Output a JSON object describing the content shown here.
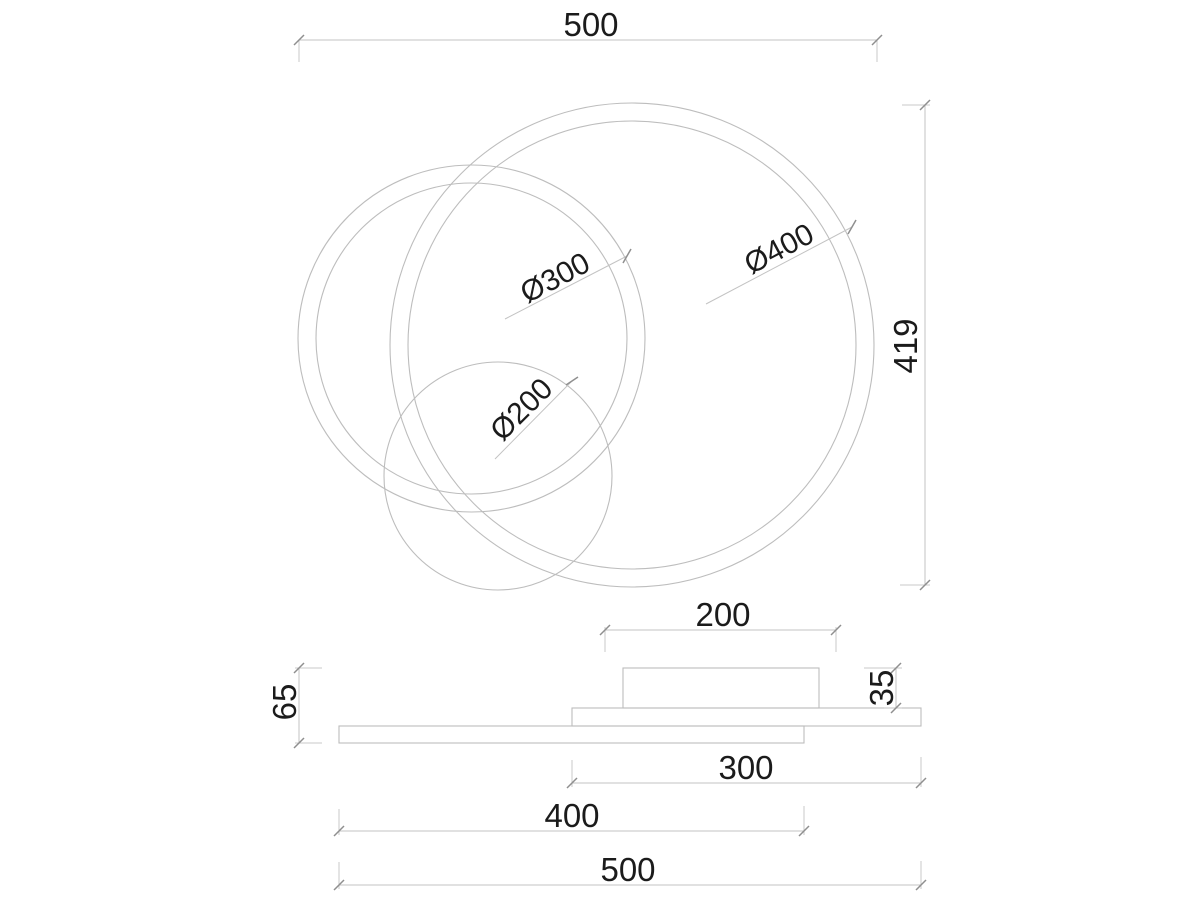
{
  "drawing": {
    "kind": "technical dimension drawing",
    "subject": "ceiling lamp with three overlapping rings (top view) and side elevation",
    "colors": {
      "background": "#ffffff",
      "line": "#bdbdbd",
      "text": "#1b1b1b"
    },
    "top_view": {
      "overall_width": {
        "label": "500",
        "value_mm": 500
      },
      "overall_height": {
        "label": "419",
        "value_mm": 419
      },
      "ring_large": {
        "label": "Ø400",
        "value_mm": 400
      },
      "ring_medium": {
        "label": "Ø300",
        "value_mm": 300
      },
      "disc_small": {
        "label": "Ø200",
        "value_mm": 200
      }
    },
    "side_view": {
      "canopy_width": {
        "label": "200",
        "value_mm": 200
      },
      "canopy_height": {
        "label": "35",
        "value_mm": 35
      },
      "overall_height": {
        "label": "65",
        "value_mm": 65
      },
      "upper_plate_width": {
        "label": "300",
        "value_mm": 300
      },
      "lower_plate_width": {
        "label": "400",
        "value_mm": 400
      },
      "overall_width": {
        "label": "500",
        "value_mm": 500
      }
    }
  }
}
